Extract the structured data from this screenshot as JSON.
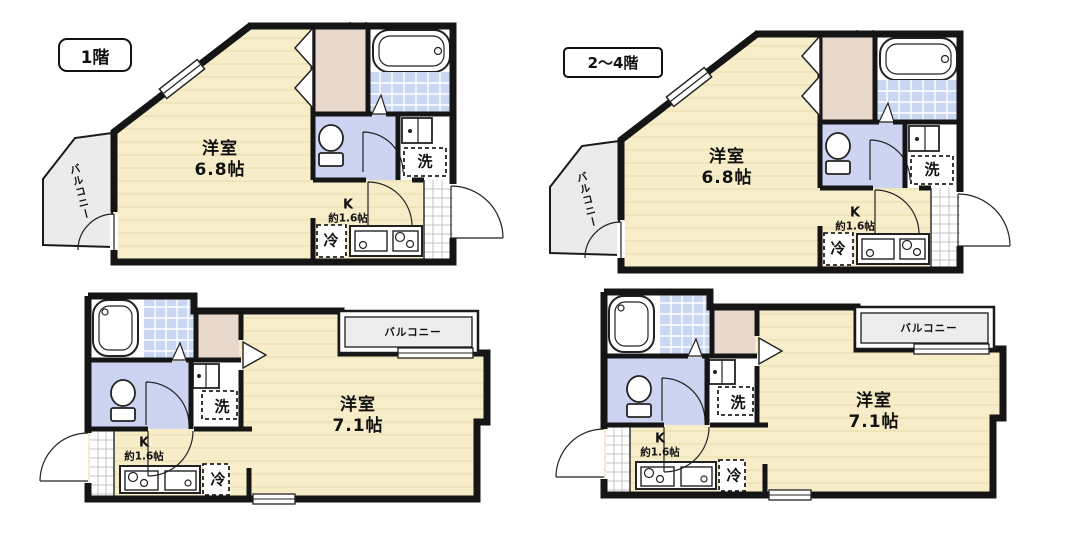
{
  "page": {
    "background": "#ffffff",
    "description": "apartment floor plans"
  },
  "legend": {
    "floor1": "1階",
    "floor2to4": "2～4階"
  },
  "unit_a": {
    "room": "洋室",
    "size": "6.8帖",
    "kitchen": "K",
    "kitchen_size": "約1.6帖",
    "washer": "洗",
    "fridge": "冷",
    "balcony": "バルコニー"
  },
  "unit_b": {
    "room": "洋室",
    "size": "7.1帖",
    "kitchen": "K",
    "kitchen_size": "約1.6帖",
    "washer": "洗",
    "fridge": "冷",
    "balcony": "バルコニー"
  },
  "colors": {
    "wall": "#151515",
    "floor_cream": "#F7EDC9",
    "floor_stripe": "#EADFB2",
    "tile_blue": "#C9D7F2",
    "toilet_blue": "#CDD4F1",
    "closet_pink": "#E8D8CC",
    "balcony_gray": "#EBEBEB"
  }
}
